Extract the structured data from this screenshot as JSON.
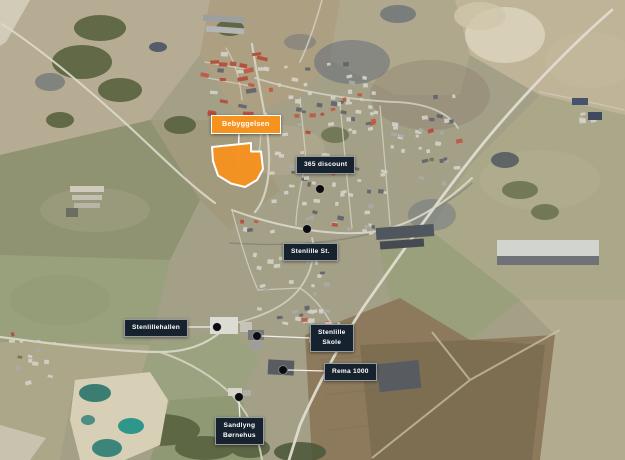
{
  "map_annotations": {
    "site": {
      "label": "Bebyggelsen"
    },
    "pois": [
      {
        "id": "discount",
        "label": "365 discount"
      },
      {
        "id": "station",
        "label": "Stenlille St."
      },
      {
        "id": "hallen",
        "label": "Stenlillehallen"
      },
      {
        "id": "skole",
        "lines": [
          "Stenlille",
          "Skole"
        ]
      },
      {
        "id": "rema",
        "label": "Rema 1000"
      },
      {
        "id": "bornehus",
        "lines": [
          "Sandlyng",
          "Børnehus"
        ]
      }
    ]
  },
  "colors": {
    "site_fill": "#F6921E",
    "site_outline": "#FFFFFF",
    "poi_label_background": "#16222E",
    "poi_label_text": "#FFFFFF",
    "poi_marker_dot": "#0B0C0F",
    "leader_line": "#F2F0E8"
  }
}
